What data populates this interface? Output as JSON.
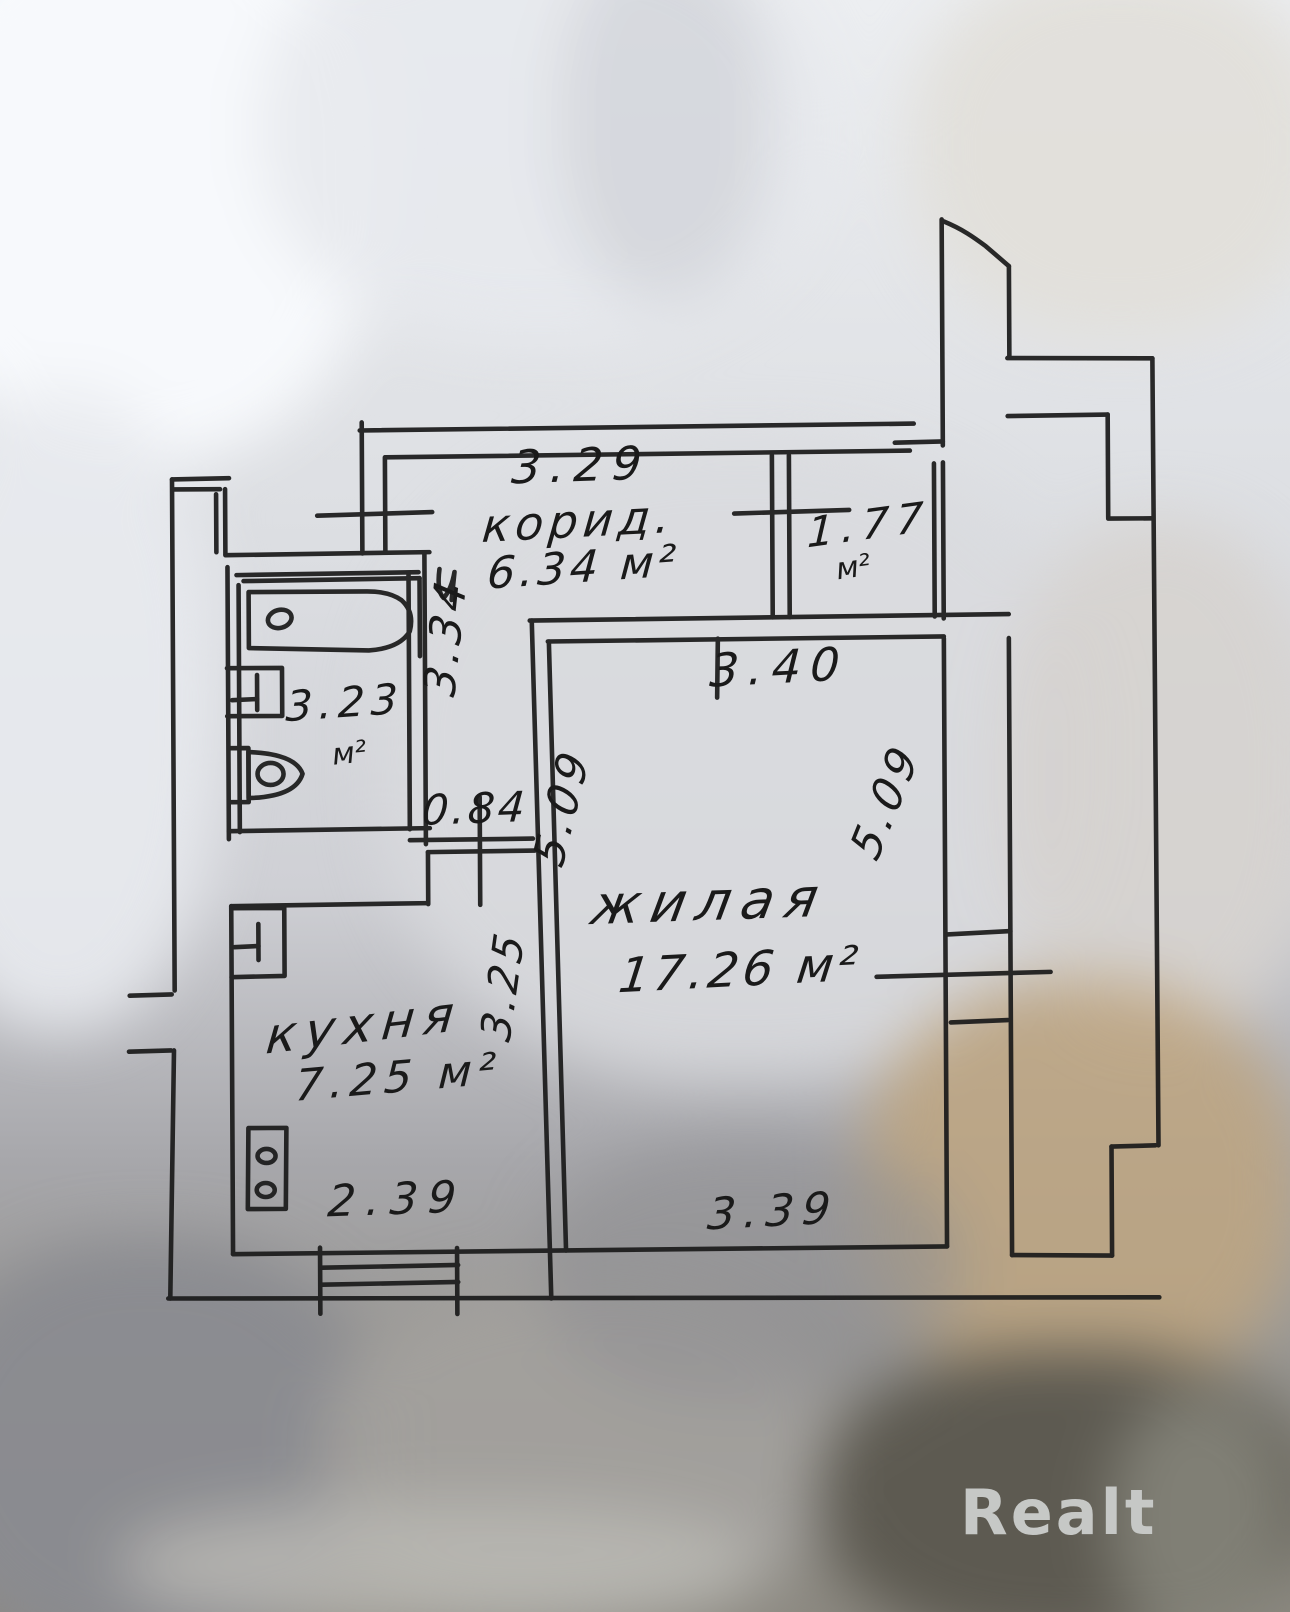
{
  "watermark": {
    "text": "Realt",
    "color": "#c6c8c6"
  },
  "floorplan": {
    "line_color": "#1b1b1b",
    "rooms": {
      "corridor": {
        "name": "корид.",
        "area": "6.34 м²"
      },
      "closet": {
        "area": "1.77",
        "unit": "м²"
      },
      "living": {
        "name": "жилая",
        "area": "17.26 м²"
      },
      "kitchen": {
        "name": "кухня",
        "area": "7.25 м²"
      },
      "bathroom": {
        "area": "3.23",
        "unit": "м²"
      }
    },
    "dimensions": {
      "corridor_width": "3.29",
      "corridor_depth": "3.34",
      "living_top_width": "3.40",
      "living_left_height": "5.09",
      "living_right_height": "5.09",
      "living_bottom_width": "3.39",
      "kitchen_bottom_width": "2.39",
      "kitchen_height": "3.25",
      "door_opening_width": "0.84"
    }
  }
}
